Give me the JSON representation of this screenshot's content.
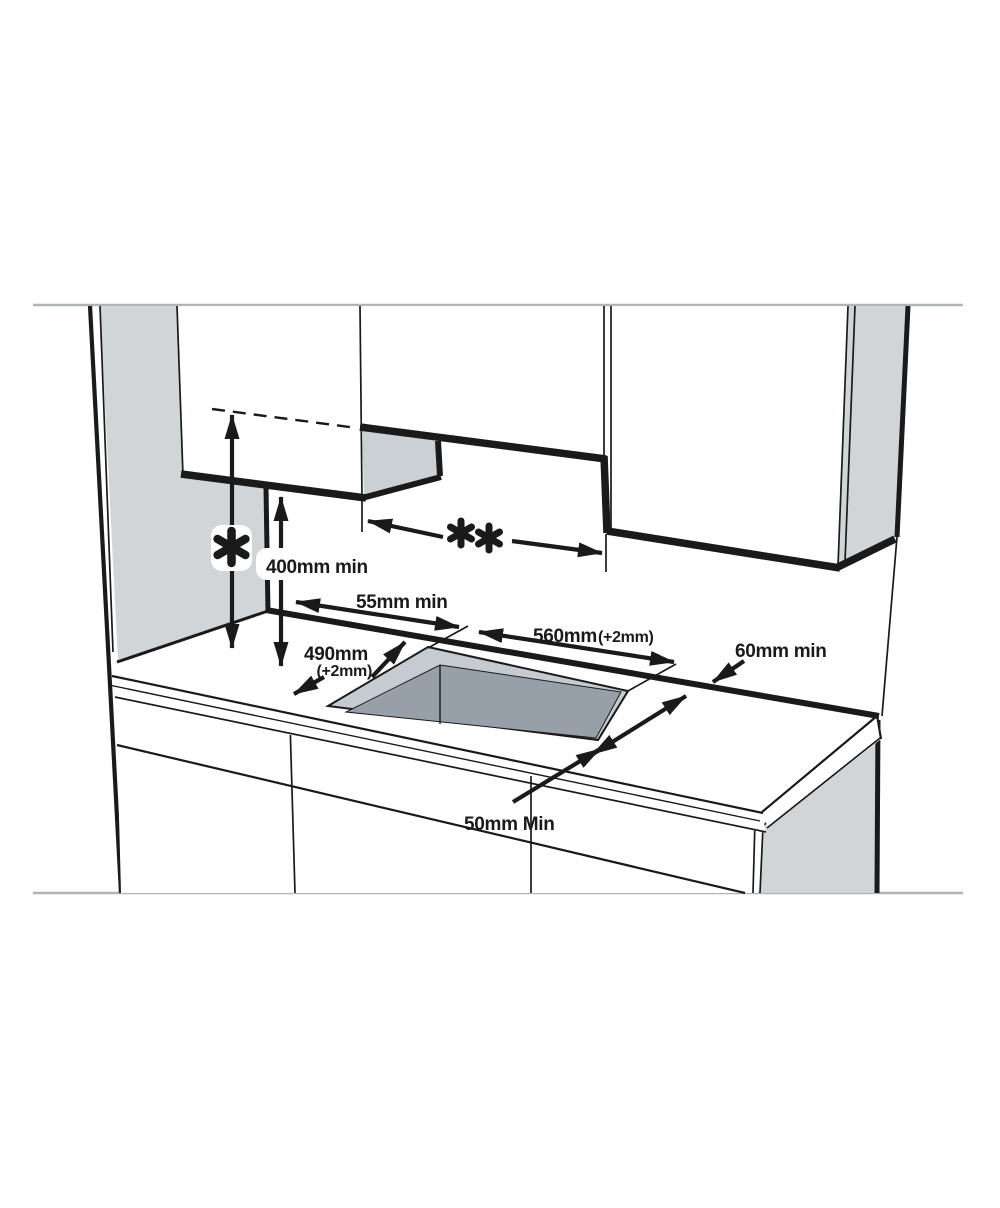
{
  "diagram": {
    "type": "hob-worktop-installation-clearance-diagram",
    "labels": {
      "hood_clearance_symbol": "*",
      "recess_width_symbol": "**",
      "cabinet_to_worktop": "400mm min",
      "rear_edge_clearance": "55mm min",
      "cutout_width": "560mm",
      "cutout_width_tolerance": "(+2mm)",
      "cutout_depth": "490mm",
      "cutout_depth_tolerance": "(+2mm)",
      "right_side_clearance": "60mm min",
      "front_edge_clearance": "50mm Min"
    },
    "colors": {
      "line": "#1a1a1a",
      "wall_gray": "#d2d5d8",
      "panel_gray": "#cbd0d4",
      "cutout_rim_gray": "#c5cbd0",
      "cutout_hole_gray": "#97a0a9",
      "guide_gray": "#b0b4b7",
      "background": "#ffffff"
    }
  }
}
